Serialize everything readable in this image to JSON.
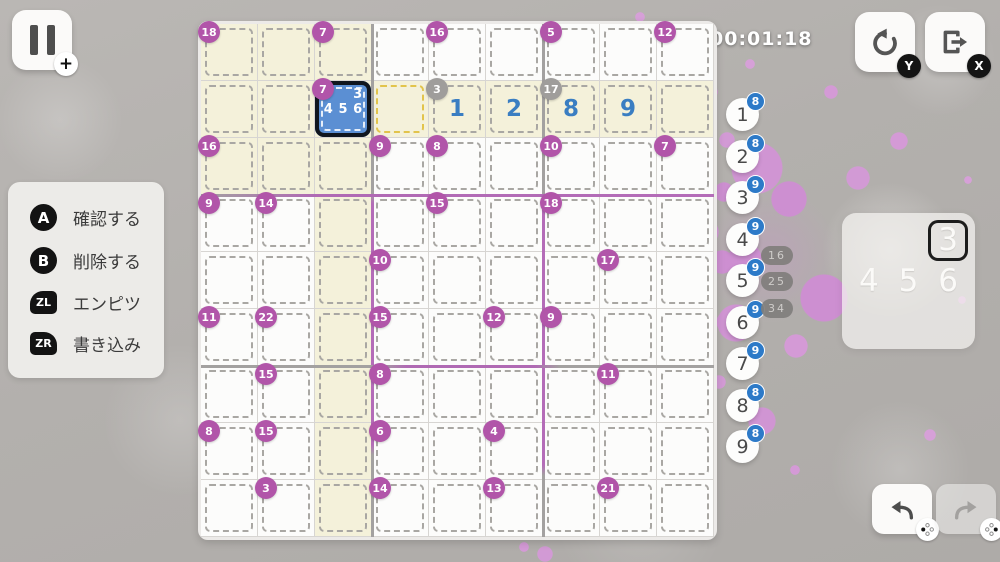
{
  "hud": {
    "timer": "00:01:18",
    "pause": {
      "icon": "pause",
      "badge": "+"
    },
    "restart": {
      "icon": "restart-arrow",
      "badge": "Y"
    },
    "exit": {
      "icon": "exit-door-arrow",
      "badge": "X"
    },
    "undo": {
      "icon": "undo-arrow",
      "badge": "dpad-left"
    },
    "redo": {
      "icon": "redo-arrow",
      "badge": "dpad-right"
    }
  },
  "legend": {
    "items": [
      {
        "button": "A",
        "label": "確認する"
      },
      {
        "button": "B",
        "label": "削除する"
      },
      {
        "button": "ZL",
        "label": "エンピツ"
      },
      {
        "button": "ZR",
        "label": "書き込み"
      }
    ]
  },
  "board": {
    "size": 9,
    "highlighted_row": 2,
    "highlighted_col": 3,
    "highlighted_box": "rows1-3_cols1-3",
    "selected_cell": {
      "row": 2,
      "col": 3,
      "pencil_marks": [
        3,
        4,
        5,
        6
      ]
    },
    "active_cage_extra_cell": {
      "row": 2,
      "col": 4
    },
    "filled_cells": [
      {
        "row": 2,
        "col": 5,
        "value": 1
      },
      {
        "row": 2,
        "col": 6,
        "value": 2
      },
      {
        "row": 2,
        "col": 7,
        "value": 8
      },
      {
        "row": 2,
        "col": 8,
        "value": 9
      }
    ],
    "cages": [
      {
        "row": 1,
        "col": 1,
        "sum": 18,
        "complete": false
      },
      {
        "row": 1,
        "col": 3,
        "sum": 7,
        "complete": false
      },
      {
        "row": 1,
        "col": 5,
        "sum": 16,
        "complete": false
      },
      {
        "row": 1,
        "col": 7,
        "sum": 5,
        "complete": false
      },
      {
        "row": 1,
        "col": 9,
        "sum": 12,
        "complete": false
      },
      {
        "row": 2,
        "col": 3,
        "sum": 7,
        "complete": false
      },
      {
        "row": 2,
        "col": 5,
        "sum": 3,
        "complete": true
      },
      {
        "row": 2,
        "col": 7,
        "sum": 17,
        "complete": true
      },
      {
        "row": 3,
        "col": 1,
        "sum": 16,
        "complete": false
      },
      {
        "row": 3,
        "col": 4,
        "sum": 9,
        "complete": false
      },
      {
        "row": 3,
        "col": 5,
        "sum": 8,
        "complete": false
      },
      {
        "row": 3,
        "col": 7,
        "sum": 10,
        "complete": false
      },
      {
        "row": 3,
        "col": 9,
        "sum": 7,
        "complete": false
      },
      {
        "row": 4,
        "col": 1,
        "sum": 9,
        "complete": false
      },
      {
        "row": 4,
        "col": 2,
        "sum": 14,
        "complete": false
      },
      {
        "row": 4,
        "col": 5,
        "sum": 15,
        "complete": false
      },
      {
        "row": 4,
        "col": 7,
        "sum": 18,
        "complete": false
      },
      {
        "row": 5,
        "col": 4,
        "sum": 10,
        "complete": false
      },
      {
        "row": 5,
        "col": 8,
        "sum": 17,
        "complete": false
      },
      {
        "row": 6,
        "col": 1,
        "sum": 11,
        "complete": false
      },
      {
        "row": 6,
        "col": 2,
        "sum": 22,
        "complete": false
      },
      {
        "row": 6,
        "col": 4,
        "sum": 15,
        "complete": false
      },
      {
        "row": 6,
        "col": 6,
        "sum": 12,
        "complete": false
      },
      {
        "row": 6,
        "col": 7,
        "sum": 9,
        "complete": false
      },
      {
        "row": 7,
        "col": 2,
        "sum": 15,
        "complete": false
      },
      {
        "row": 7,
        "col": 4,
        "sum": 8,
        "complete": false
      },
      {
        "row": 7,
        "col": 8,
        "sum": 11,
        "complete": false
      },
      {
        "row": 8,
        "col": 1,
        "sum": 8,
        "complete": false
      },
      {
        "row": 8,
        "col": 2,
        "sum": 15,
        "complete": false
      },
      {
        "row": 8,
        "col": 4,
        "sum": 6,
        "complete": false
      },
      {
        "row": 8,
        "col": 6,
        "sum": 4,
        "complete": false
      },
      {
        "row": 9,
        "col": 2,
        "sum": 3,
        "complete": false
      },
      {
        "row": 9,
        "col": 4,
        "sum": 14,
        "complete": false
      },
      {
        "row": 9,
        "col": 6,
        "sum": 13,
        "complete": false
      },
      {
        "row": 9,
        "col": 8,
        "sum": 21,
        "complete": false
      }
    ]
  },
  "number_panel": {
    "items": [
      {
        "digit": 1,
        "remaining": 8
      },
      {
        "digit": 2,
        "remaining": 8
      },
      {
        "digit": 3,
        "remaining": 9
      },
      {
        "digit": 4,
        "remaining": 9
      },
      {
        "digit": 5,
        "remaining": 9
      },
      {
        "digit": 6,
        "remaining": 9
      },
      {
        "digit": 7,
        "remaining": 9
      },
      {
        "digit": 8,
        "remaining": 8
      },
      {
        "digit": 9,
        "remaining": 8
      }
    ]
  },
  "combo_hints": [
    "16",
    "25",
    "34"
  ],
  "pencil_popup": {
    "digits": [
      3,
      4,
      5,
      6
    ],
    "cursor": 3
  },
  "colors": {
    "background": "#b4b1ae",
    "splatter": "#cf92d2",
    "highlight_yellow": "#f4f1da",
    "cage_circle": "#b155a9",
    "cage_circle_done": "#9f9d9b",
    "value_blue": "#3a7ec2",
    "count_badge_blue": "#2d7ac8",
    "selected_cell_blue": "#5b8fd3",
    "selected_border": "#10161f",
    "purple_line": "#b46cb8",
    "active_cage_dash": "#e2c44c"
  }
}
